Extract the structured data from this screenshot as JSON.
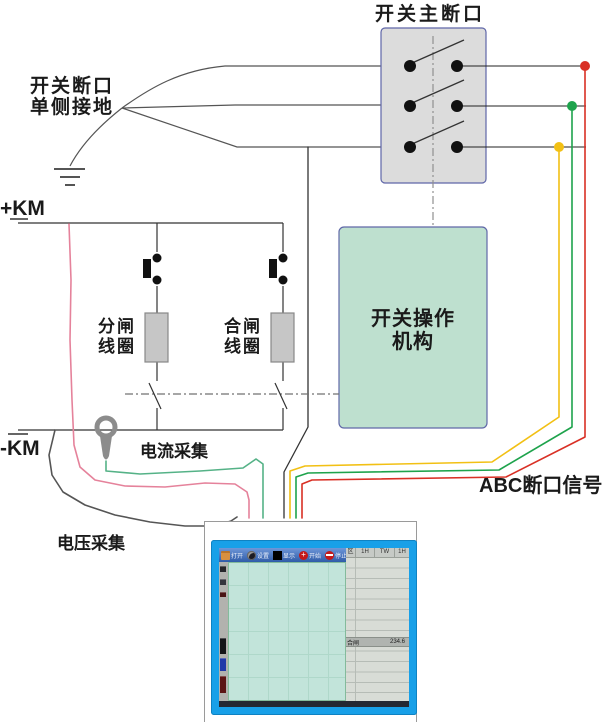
{
  "diagram": {
    "main_break_title": "开关主断口",
    "break_ground": [
      "开关断口",
      "单侧接地"
    ],
    "plus_km": "+KM",
    "minus_km": "-KM",
    "open_coil": [
      "分闸",
      "线圈"
    ],
    "close_coil": [
      "合闸",
      "线圈"
    ],
    "mechanism": [
      "开关操作",
      "机构"
    ],
    "current_sampling": "电流采集",
    "voltage_sampling": "电压采集",
    "abc_signal": "ABC断口信号",
    "colors": {
      "phase_a_red": "#d93025",
      "phase_b_green": "#1ea34c",
      "phase_c_yellow": "#f2c014",
      "trip_wire_pink": "#e5829b",
      "current_wire_green": "#55b287",
      "voltage_wire_gray": "#555555",
      "break_box_fill": "#dcdcdc",
      "mechanism_fill": "#bee0cf",
      "photo_border_blue": "#18a0e8"
    }
  },
  "instrument": {
    "toolbar": {
      "items": [
        {
          "icon": "folder-icon",
          "label": "打开"
        },
        {
          "icon": "camera-icon",
          "label": "设置"
        },
        {
          "icon": "display-icon",
          "label": "显示"
        },
        {
          "icon": "start-icon",
          "label": "开始"
        },
        {
          "icon": "stop-icon",
          "label": "停止"
        }
      ]
    },
    "table": {
      "headers": [
        "区",
        "1H",
        "TW",
        "1H"
      ],
      "selected_row": {
        "label": "合闸",
        "value": "234.6"
      }
    }
  }
}
